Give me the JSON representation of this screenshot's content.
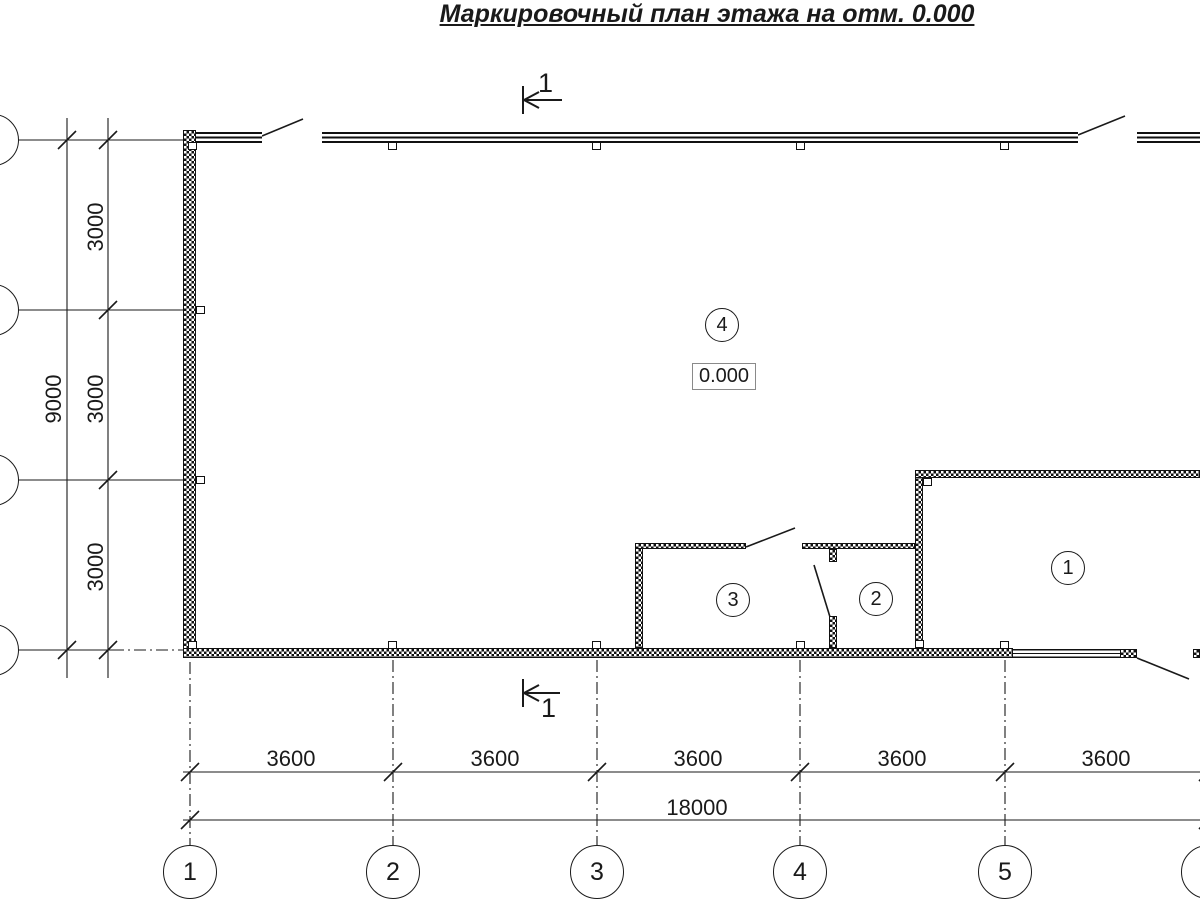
{
  "title": "Маркировочный план этажа на отм. 0.000",
  "section_marks": {
    "top": "1",
    "bottom": "1"
  },
  "elevation": {
    "value": "0.000"
  },
  "room_labels": [
    "1",
    "2",
    "3",
    "4"
  ],
  "grid_columns": [
    "1",
    "2",
    "3",
    "4",
    "5",
    "6"
  ],
  "dimensions": {
    "vertical": {
      "segments": [
        "3000",
        "3000",
        "3000"
      ],
      "total": "9000"
    },
    "horizontal": {
      "segments": [
        "3600",
        "3600",
        "3600",
        "3600",
        "3600"
      ],
      "total": "18000"
    }
  },
  "colors": {
    "ink": "#1a1a1a",
    "paper": "#ffffff"
  }
}
